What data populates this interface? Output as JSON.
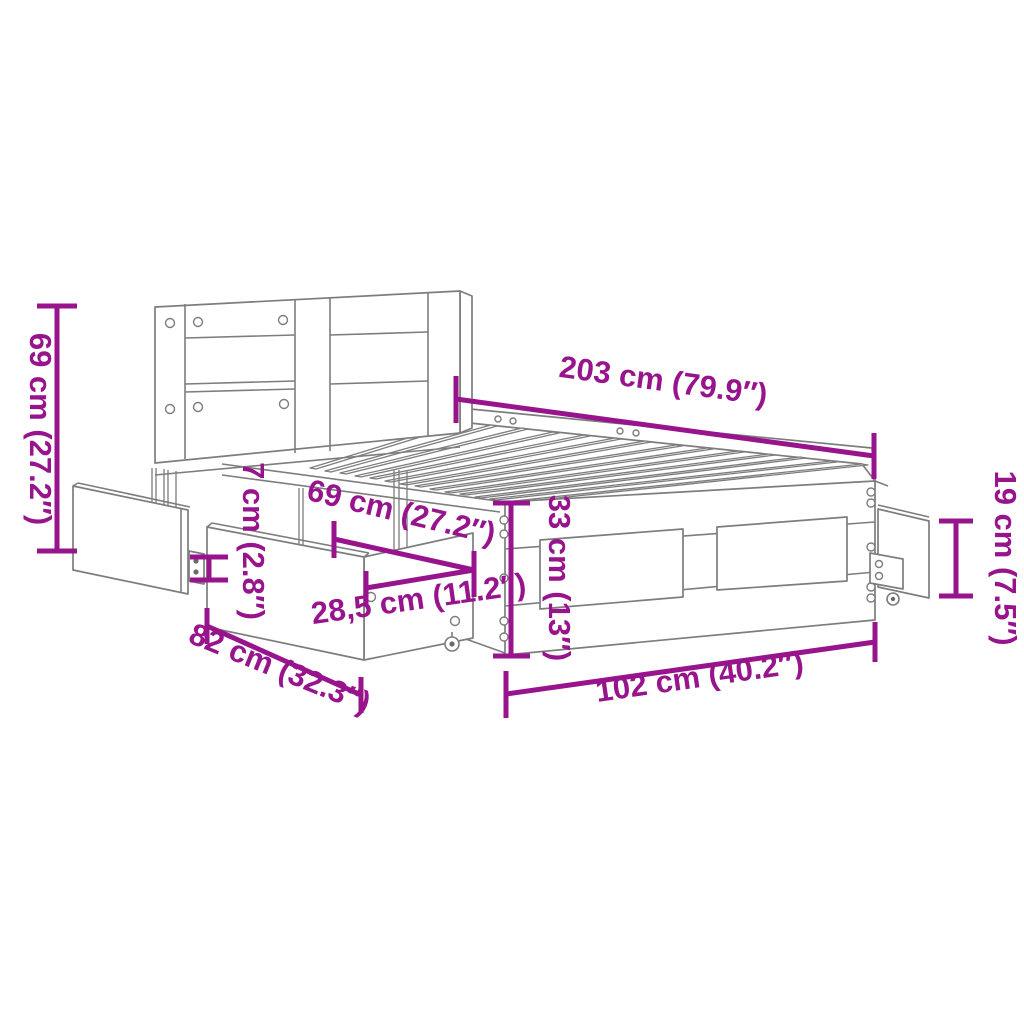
{
  "diagram": {
    "title": "Bed frame with headboard and storage drawers — dimension diagram",
    "accent_color": "#97148D",
    "line_color": "#7D7D7D",
    "background_color": "#FFFFFF",
    "dimensions": [
      {
        "id": "headboard-height",
        "label": "69 cm (27.2″)"
      },
      {
        "id": "total-length",
        "label": "203 cm (79.9″)"
      },
      {
        "id": "floor-clearance",
        "label": "7 cm (2.8″)"
      },
      {
        "id": "drawer-length",
        "label": "69 cm (27.2″)"
      },
      {
        "id": "frame-height",
        "label": "33 cm (13″)"
      },
      {
        "id": "drawer-height",
        "label": "28,5 cm (11.2″)"
      },
      {
        "id": "side-drawer-height",
        "label": "19 cm (7.5″)"
      },
      {
        "id": "drawer-depth",
        "label": "82 cm (32.3″)"
      },
      {
        "id": "total-width",
        "label": "102 cm (40.2″)"
      }
    ]
  }
}
